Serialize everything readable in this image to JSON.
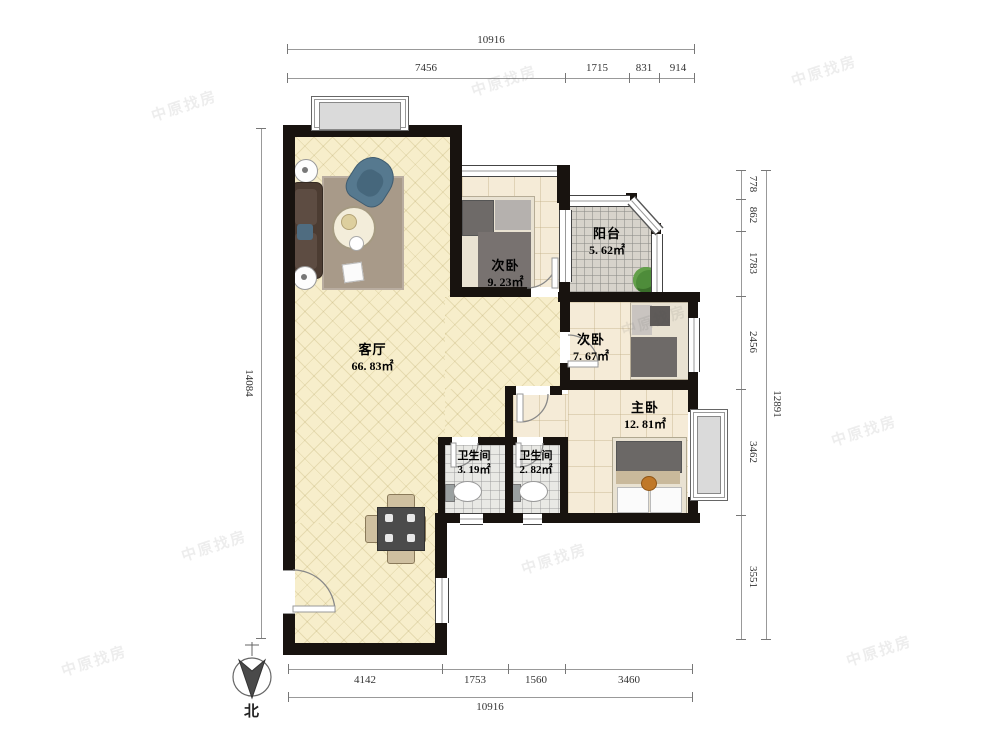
{
  "rooms": [
    {
      "name": "客厅",
      "area": "66. 83㎡"
    },
    {
      "name": "次卧",
      "area": "9. 23㎡"
    },
    {
      "name": "阳台",
      "area": "5. 62㎡"
    },
    {
      "name": "次卧",
      "area": "7. 67㎡"
    },
    {
      "name": "主卧",
      "area": "12. 81㎡"
    },
    {
      "name": "卫生间",
      "area": "3. 19㎡"
    },
    {
      "name": "卫生间",
      "area": "2. 82㎡"
    }
  ],
  "dims": {
    "top": {
      "total": "10916",
      "segments": [
        "7456",
        "1715",
        "831",
        "914"
      ]
    },
    "bottom": {
      "total": "10916",
      "segments": [
        "4142",
        "1753",
        "1560",
        "3460"
      ]
    },
    "left": {
      "total": "14084"
    },
    "right": {
      "total": "12891",
      "segments": [
        "778",
        "862",
        "1783",
        "2456",
        "3462",
        "3551"
      ]
    }
  },
  "compass": {
    "label": "北"
  },
  "watermark": {
    "text": "中原找房"
  },
  "colors": {
    "wall": "#18130f",
    "living_floor": "#f7eecb",
    "bedroom_floor": "#f5ebd7",
    "balcony_floor": "#d7d3cb",
    "bath_floor": "#e9e9e5",
    "sofa": "#4c3c32",
    "armchair": "#56798f",
    "blanket": "#6e6a68",
    "rug": "#a89a89",
    "plant": "#4e8c3a"
  }
}
